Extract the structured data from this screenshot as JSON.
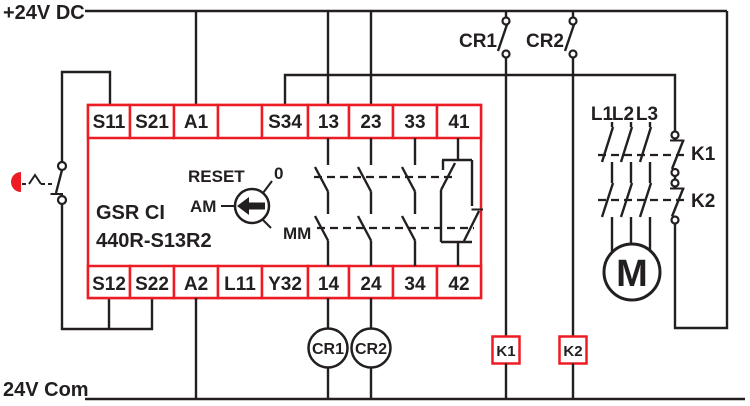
{
  "rails": {
    "top_label": "+24V DC",
    "bottom_label": "24V Com"
  },
  "safety_relay": {
    "model_line1": "GSR CI",
    "model_line2": "440R-S13R2",
    "top_terminals": [
      "S11",
      "S21",
      "A1",
      "",
      "S34",
      "13",
      "23",
      "33",
      "41"
    ],
    "bottom_terminals": [
      "S12",
      "S22",
      "A2",
      "L11",
      "Y32",
      "14",
      "24",
      "34",
      "42"
    ],
    "reset_selector": {
      "label": "RESET",
      "positions": {
        "top": "0",
        "left": "AM",
        "bottom": "MM"
      }
    }
  },
  "monitoring_contacts": {
    "cr1": "CR1",
    "cr2": "CR2"
  },
  "relay_coils": {
    "cr1": "CR1",
    "cr2": "CR2"
  },
  "contactor_coils": {
    "k1": "K1",
    "k2": "K2"
  },
  "motor_branch": {
    "phase_labels": [
      "L1",
      "L2",
      "L3"
    ],
    "aux_contact_labels": [
      "K1",
      "K2"
    ],
    "motor_label": "M"
  },
  "colors": {
    "accent_red": "#ED1C24",
    "line_black": "#231F20",
    "background": "#FFFFFF"
  }
}
